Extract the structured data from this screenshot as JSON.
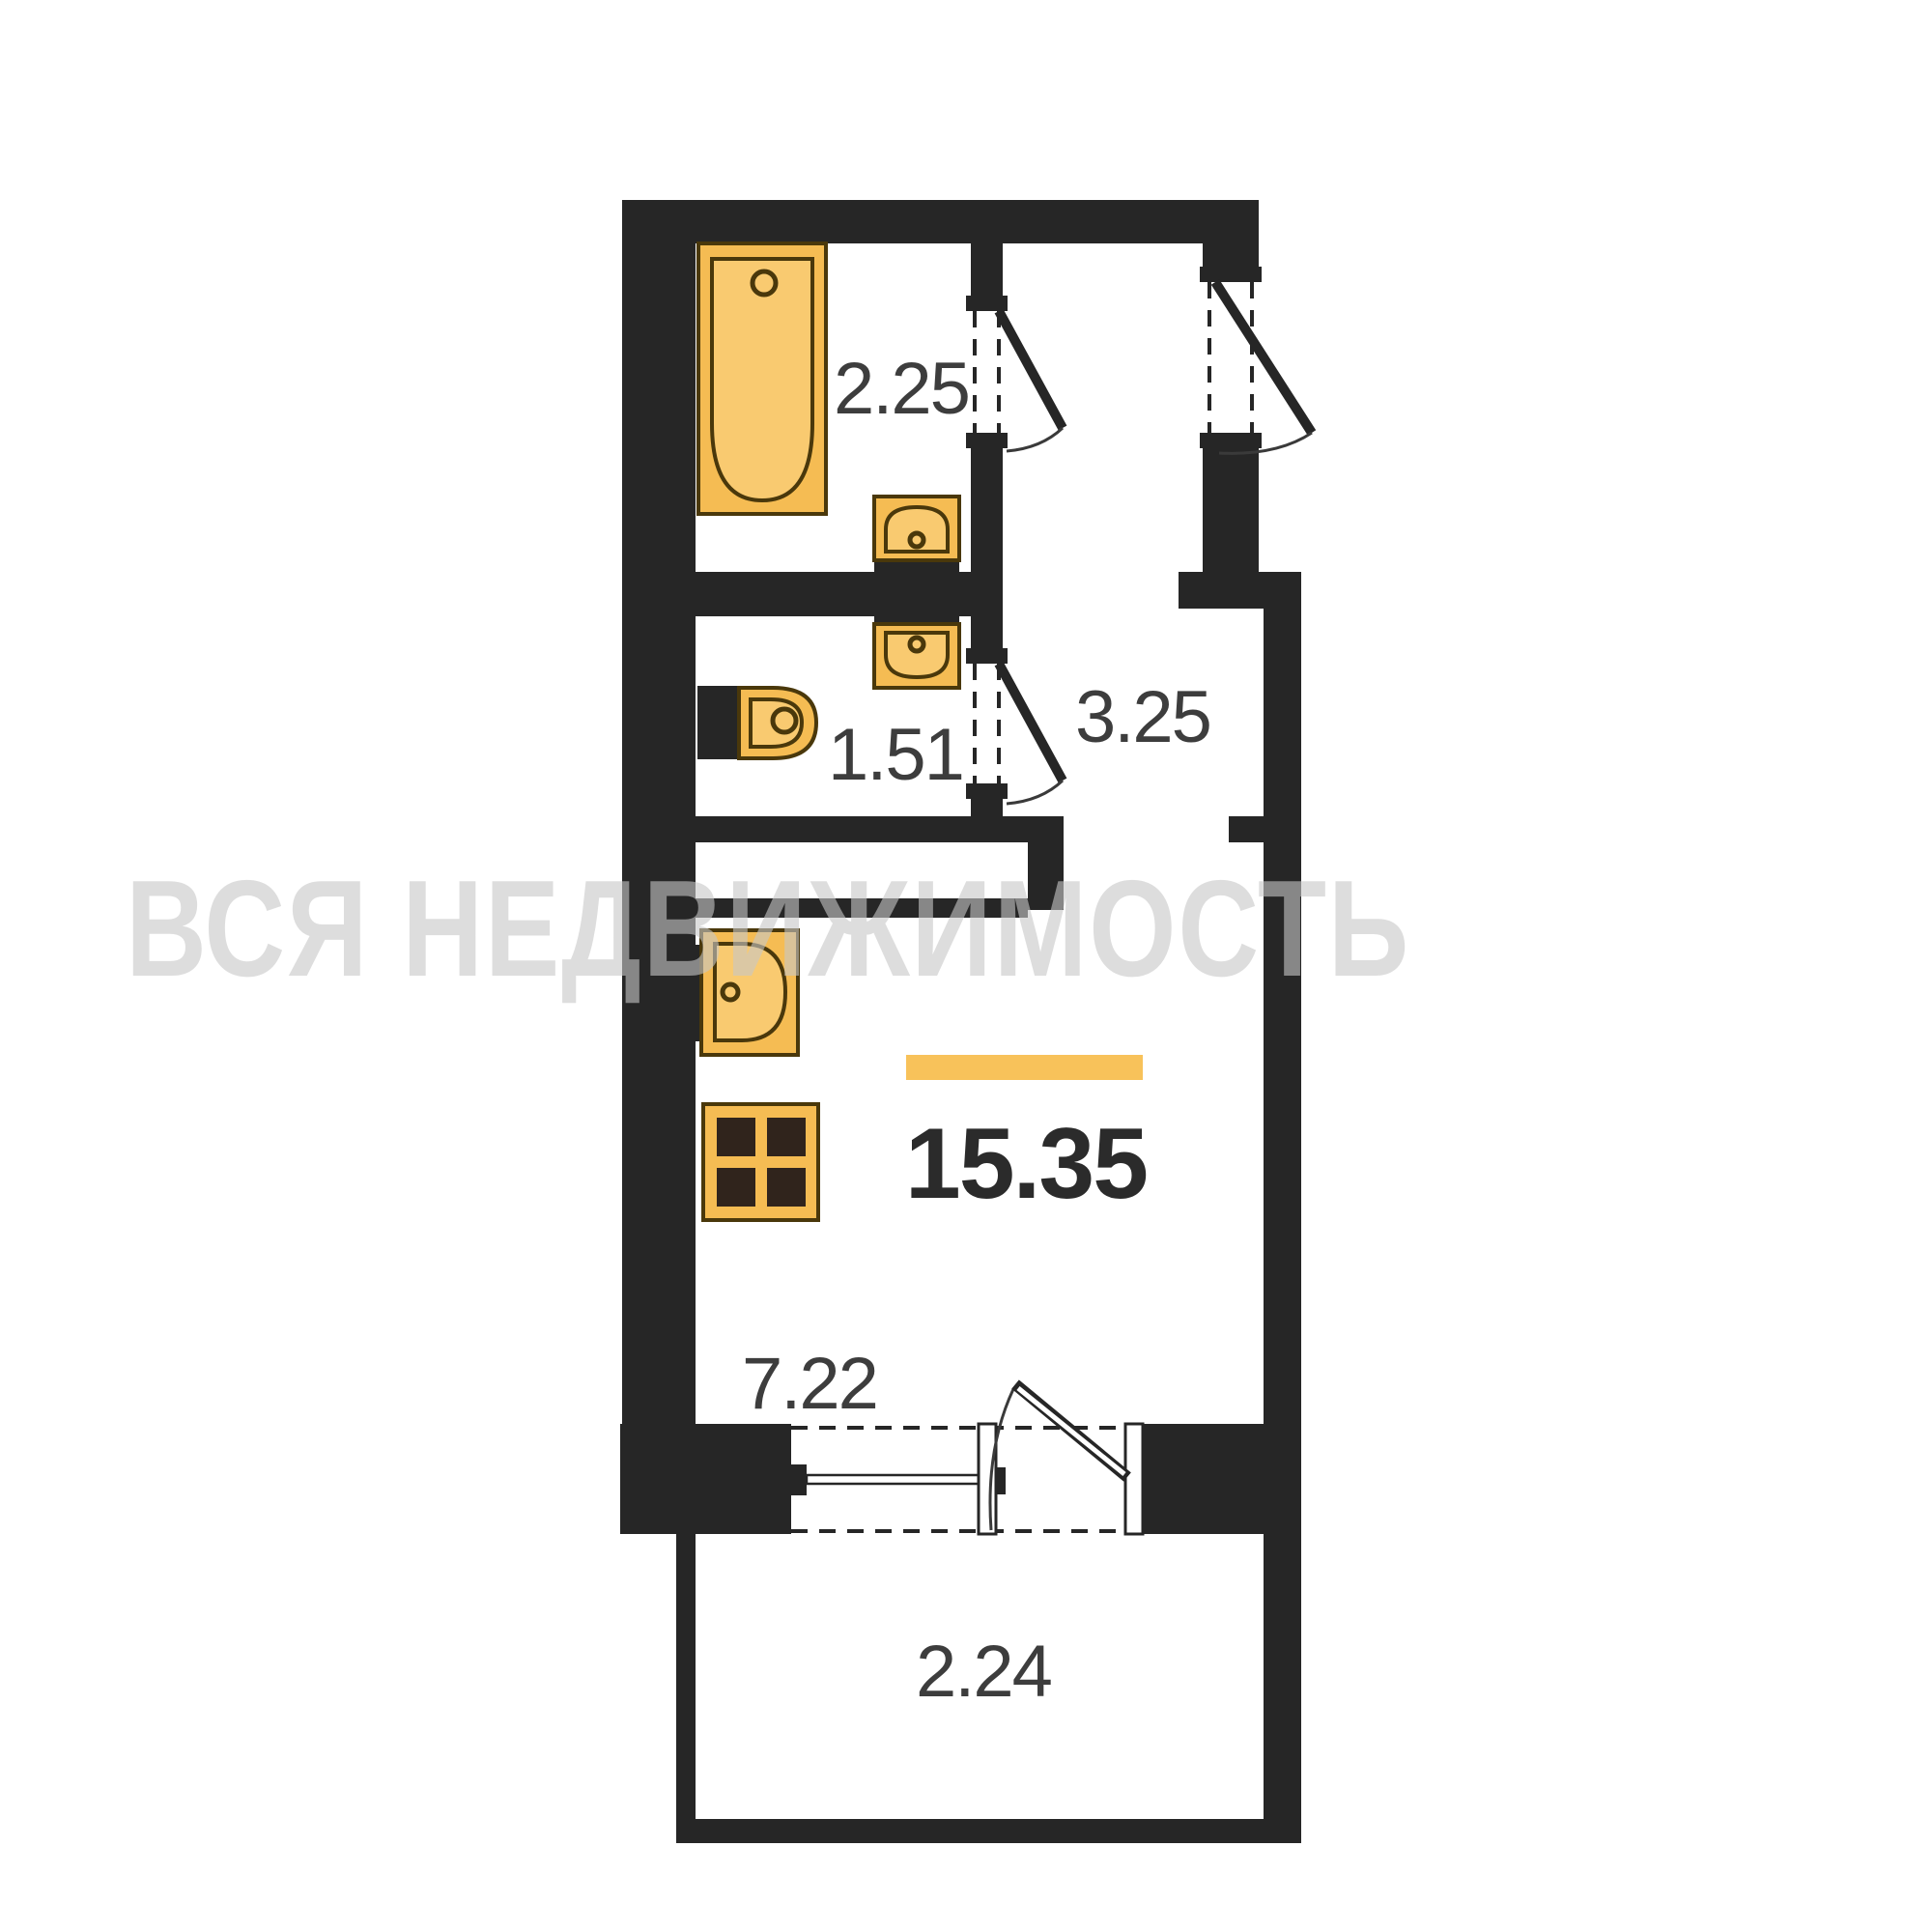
{
  "watermark": {
    "text": "ВСЯ НЕДВИЖИМОСТЬ"
  },
  "colors": {
    "bg": "#ffffff",
    "wall": "#262626",
    "fixture_fill": "#f5bc53",
    "fixture_fill_light": "#f9ca70",
    "fixture_stroke": "#4a380b",
    "burner": "#30241c",
    "accent_bar": "#f8c25a",
    "label": "#3d3d3d",
    "area_label": "#2b2b2b",
    "watermark": "#c8c8c8"
  },
  "plan": {
    "type": "studio-apartment-floor-plan",
    "total_area_highlighted": "15.35",
    "rooms": {
      "bathroom": {
        "area": "2.25"
      },
      "wc": {
        "area": "1.51"
      },
      "hallway": {
        "area": "3.25"
      },
      "living": {
        "area": "15.35"
      },
      "kitchen": {
        "area": "7.22"
      },
      "balcony": {
        "area": "2.24"
      }
    },
    "fixtures": [
      "bathtub-icon",
      "wall-sink-icon",
      "wall-sink-icon",
      "toilet-icon",
      "kitchen-sink-icon",
      "stove-4-burner-icon",
      "window-icon",
      "balcony-door-icon",
      "entry-door-icon",
      "interior-door-icon",
      "interior-door-icon"
    ]
  }
}
